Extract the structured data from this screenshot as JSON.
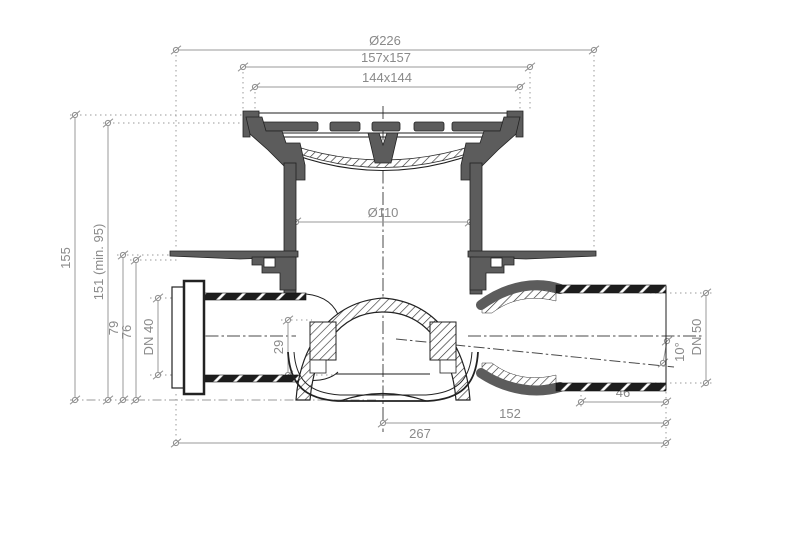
{
  "drawing": {
    "type": "technical-drawing-cross-section",
    "subject": "floor-drain",
    "units": "mm",
    "colors": {
      "line": "#1f1f1f",
      "metal_fill": "#5c5c5c",
      "dimension": "#8a8a8a"
    },
    "dimensions": {
      "flange_diameter": "Ø226",
      "frame_size": "157x157",
      "grate_size": "144x144",
      "body_diameter": "Ø110",
      "total_height": "155",
      "install_height": "151 (min. 95)",
      "flange_top_height": "79",
      "seal_level_height": "76",
      "inlet_pipe": "DN 40",
      "trap_depth": "29",
      "outlet_pipe": "DN 50",
      "outlet_slope": "10°",
      "outlet_stub_length": "46",
      "outlet_center_length": "152",
      "total_length": "267"
    }
  }
}
